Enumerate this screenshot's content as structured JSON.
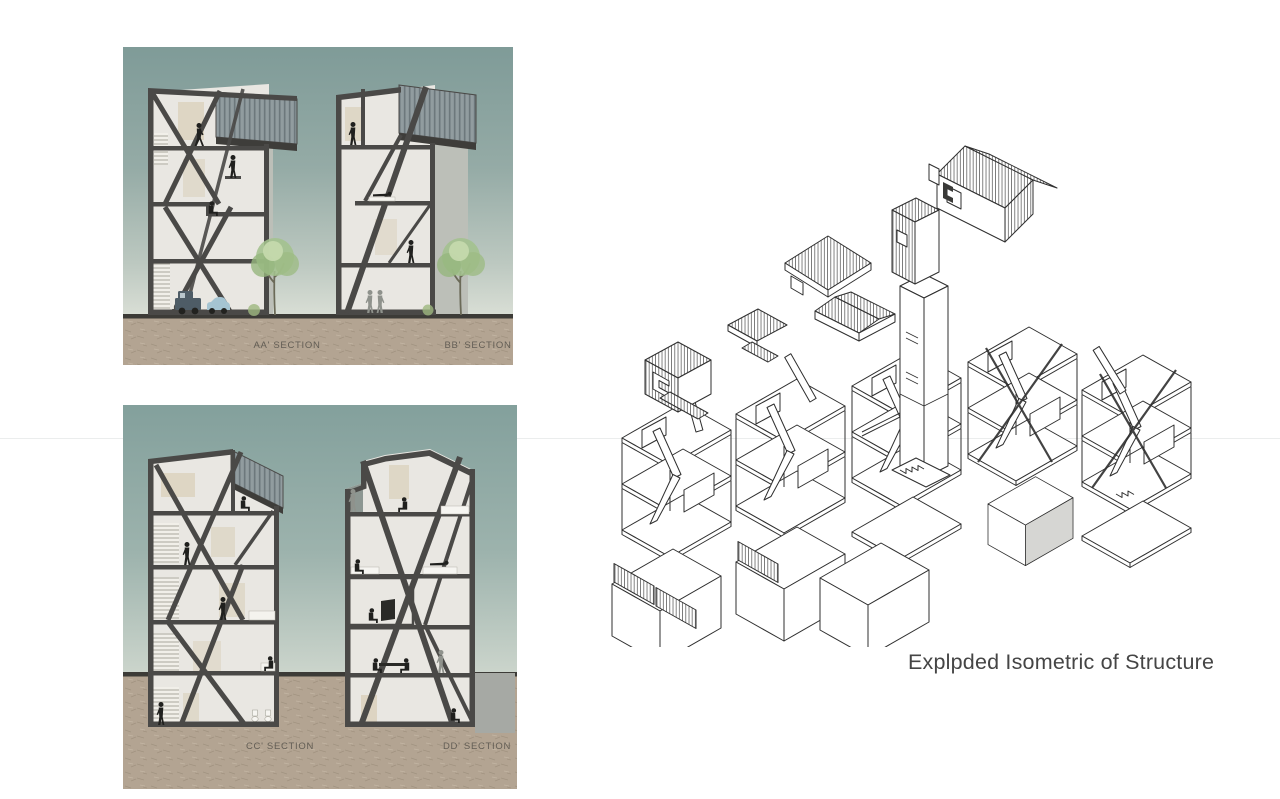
{
  "page": {
    "width": 1280,
    "height": 799,
    "background": "#ffffff"
  },
  "panels": {
    "sections_ab": {
      "labels": [
        {
          "text": "AA' SECTION"
        },
        {
          "text": "BB' SECTION"
        }
      ]
    },
    "sections_cd": {
      "labels": [
        {
          "text": "CC' SECTION"
        },
        {
          "text": "DD' SECTION"
        }
      ]
    }
  },
  "isometric": {
    "caption": "Explpded Isometric of Structure"
  },
  "colors": {
    "sky_top": "#7f9b98",
    "sky_bottom": "#dadfd6",
    "ground_tan": "#b3a492",
    "ground_line": "#3c3b37",
    "frame_dark": "#4a4947",
    "interior_light": "#e9e7e2",
    "side_wall_gray": "#bcbfb8",
    "cladding_gray": "#8b969a",
    "foliage_green": "#a3c18d",
    "trunk_brown": "#6b6a58",
    "silhouette_black": "#20201e",
    "silhouette_gray": "#8f928c",
    "truck_blue": "#4e5c66",
    "car_blue": "#a5c4d2",
    "iso_line": "#2f2f2f",
    "caption_text": "#454545",
    "label_text": "#55514a"
  }
}
